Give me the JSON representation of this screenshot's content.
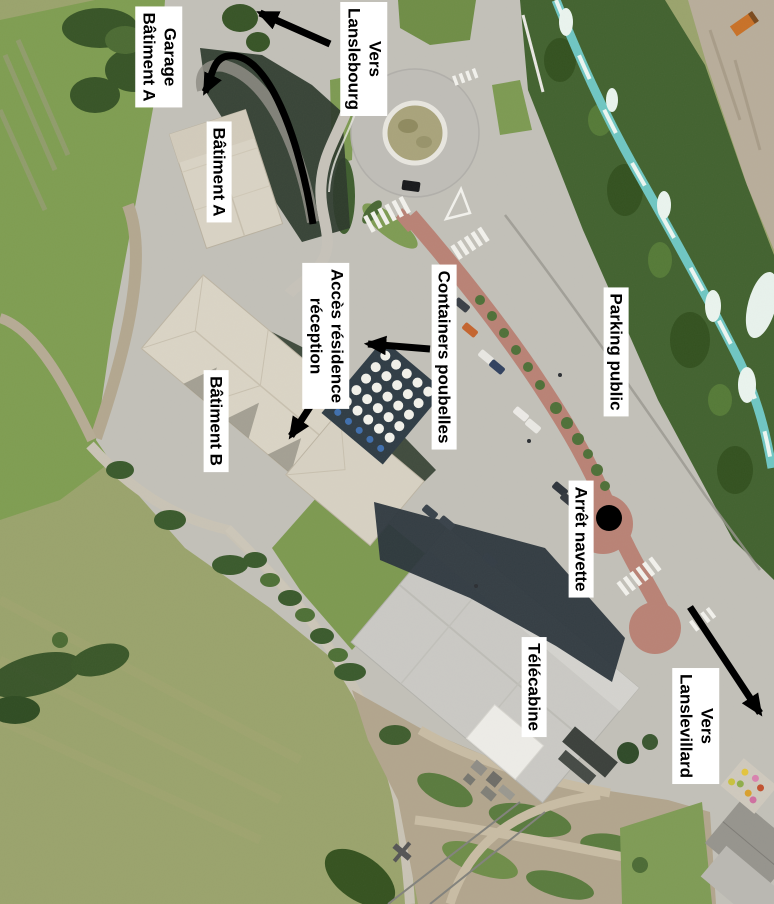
{
  "map": {
    "description": "Annotated aerial photo of a resort / gondola base area",
    "labels": [
      {
        "id": "garage-batiment-a",
        "text": "Garage\nBâtiment A"
      },
      {
        "id": "vers-lanslebourg",
        "text": "Vers\nLanslebourg"
      },
      {
        "id": "batiment-a",
        "text": "Bâtiment A"
      },
      {
        "id": "acces-residence-reception",
        "text": "Accès résidence\nréception"
      },
      {
        "id": "containers-poubelles",
        "text": "Containers poubelles"
      },
      {
        "id": "parking-public",
        "text": "Parking public"
      },
      {
        "id": "batiment-b",
        "text": "Bâtiment B"
      },
      {
        "id": "arret-navette",
        "text": "Arrêt navette"
      },
      {
        "id": "telecabine",
        "text": "Télécabine"
      },
      {
        "id": "vers-lanslevillard",
        "text": "Vers Lanslevillard"
      }
    ],
    "arrows": [
      {
        "id": "arrow-vers-lanslebourg",
        "style": "straight",
        "direction": "up-left"
      },
      {
        "id": "arrow-garage-batiment-a",
        "style": "curved",
        "direction": "loops-to-garage"
      },
      {
        "id": "arrow-acces-reception",
        "style": "straight",
        "direction": "down-left"
      },
      {
        "id": "arrow-containers-poubelles",
        "style": "straight",
        "direction": "left"
      },
      {
        "id": "arrow-vers-lanslevillard",
        "style": "straight",
        "direction": "down-right"
      }
    ],
    "markers": [
      {
        "id": "arret-navette-dot",
        "shape": "filled-circle",
        "color": "#000000"
      }
    ],
    "colors": {
      "annotation": "#000000",
      "label_background": "#ffffff",
      "grass_bright": "#7f9d51",
      "grass_mown": "#9aa36c",
      "trees": "#42622f",
      "asphalt": "#c2c0b8",
      "red_path": "#b98275",
      "river": "#6fc6c2",
      "gravel": "#b8ad9a",
      "roof_beige": "#d9d3c4",
      "roof_gray": "#cac9c4",
      "shadow": "#2d3a2b"
    }
  }
}
